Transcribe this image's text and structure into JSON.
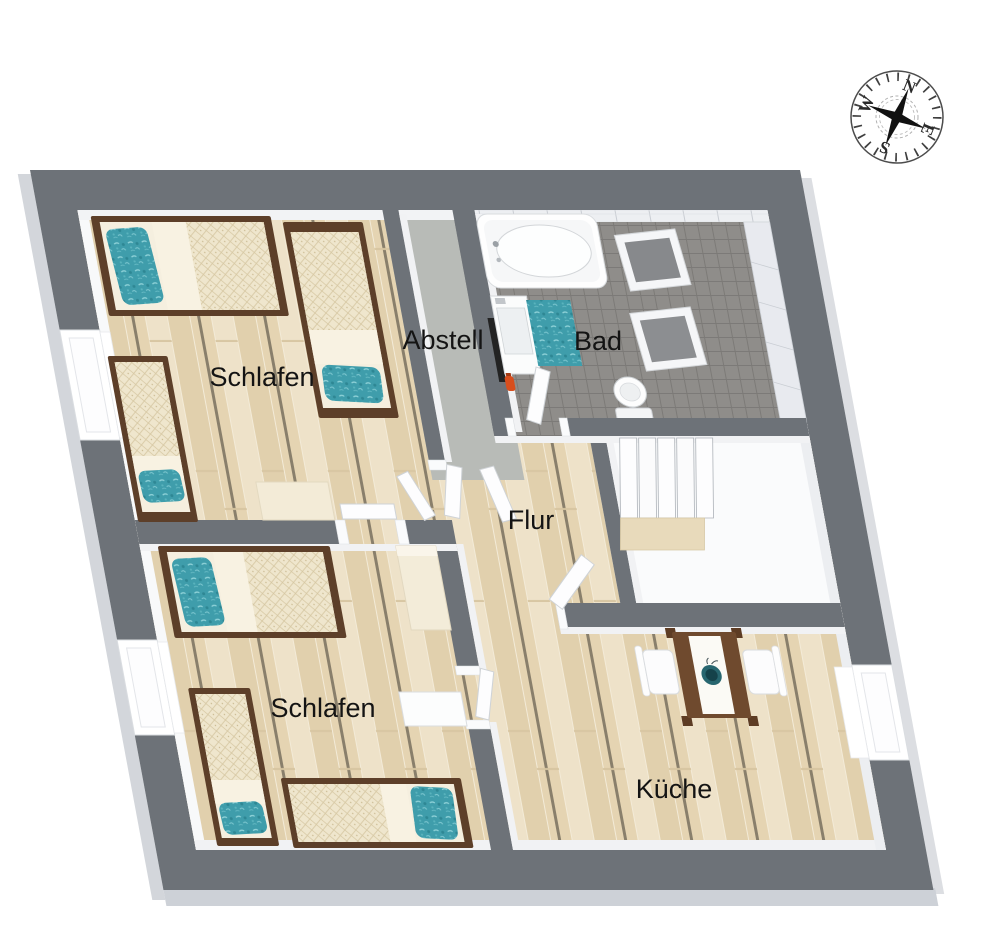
{
  "image_type": "3d-floor-plan-top-view",
  "rooms": [
    {
      "id": "schlafen-1",
      "label": "Schlafen"
    },
    {
      "id": "abstell",
      "label": "Abstell"
    },
    {
      "id": "bad",
      "label": "Bad"
    },
    {
      "id": "flur",
      "label": "Flur"
    },
    {
      "id": "schlafen-2",
      "label": "Schlafen"
    },
    {
      "id": "kueche",
      "label": "Küche"
    }
  ],
  "compass": {
    "north": "N",
    "east": "E",
    "south": "S",
    "west": "W"
  },
  "icons": [
    {
      "name": "compass-rose-icon"
    }
  ],
  "colors": {
    "wall_gray": "#6d7278",
    "wall_face_white": "#f2f3f5",
    "wood_floor": "#e8d9bc",
    "abstell_floor": "#b8bbb7",
    "bad_tile_floor": "#8f8d8a",
    "stair_floor": "#fafbfc",
    "accent_teal": "#3f9dab",
    "bed_frame_brown": "#5d3f29",
    "table_brown": "#6f4a2e",
    "extinguisher_red": "#d84e1d"
  }
}
